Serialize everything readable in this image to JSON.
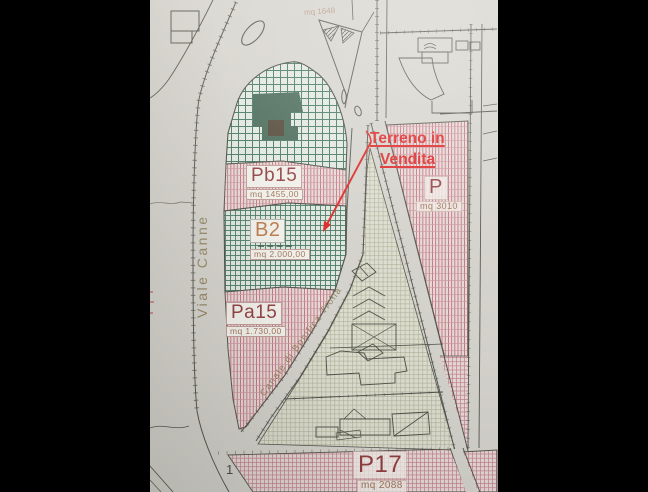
{
  "annotation": {
    "line1": "Terreno in",
    "line2": "Vendita"
  },
  "parcels": {
    "pb15": {
      "label": "Pb15",
      "area": "mq 1455,00"
    },
    "b2": {
      "label": "B2",
      "area": "mq 2.000,00"
    },
    "pa15": {
      "label": "Pa15",
      "area": "mq 1.730,00"
    },
    "p": {
      "label": "P",
      "area": "mq 3010"
    },
    "p17": {
      "label": "P17",
      "area": "mq 2088"
    },
    "top_triangle": {
      "area": "mq 1648"
    }
  },
  "streets": {
    "viale": "Viale Canne",
    "canale": "Canale di Bonifica Trona"
  },
  "markers": {
    "block_number": "1"
  },
  "colors": {
    "annotation_red": "#e01515",
    "parcel_label_maroon": "#8c3336",
    "area_text_brown": "#9a6e50",
    "b2_label_orange": "#b9743f",
    "street_text_olive": "#8d7d58",
    "zone_green_hatch": "#38705d",
    "zone_pink_hatch": "#b8596c",
    "zone_khaki_grid": "#adb293",
    "paper": "#d7d5cf",
    "letterbox": "#000000"
  }
}
